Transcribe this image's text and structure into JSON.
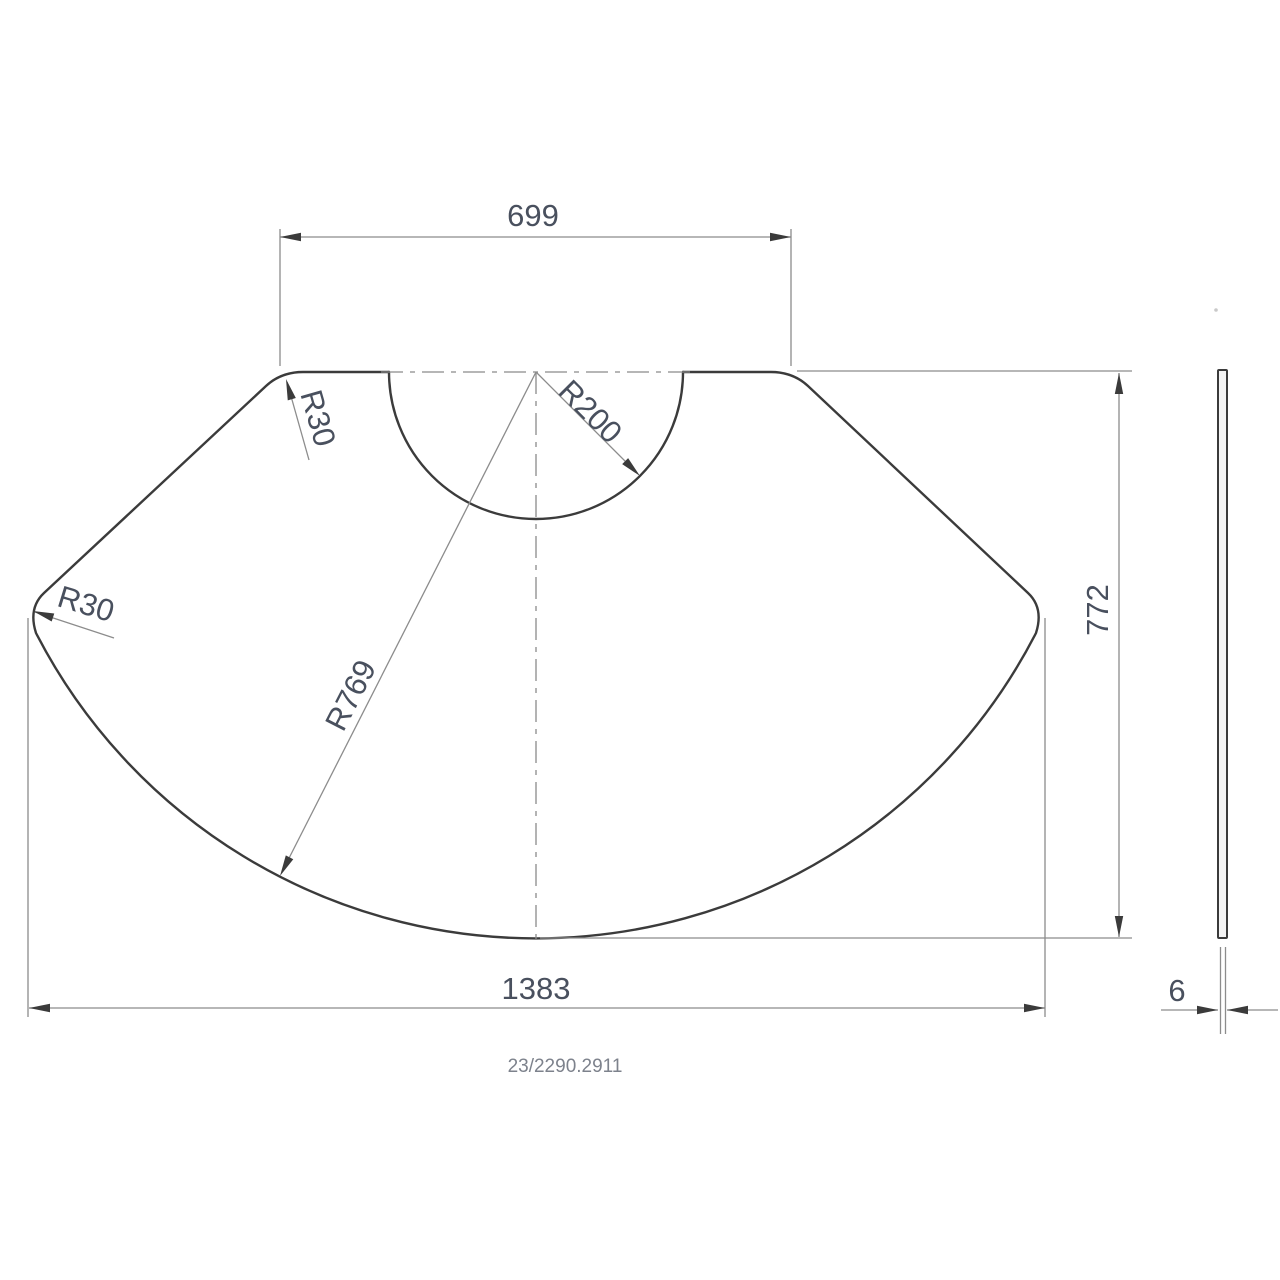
{
  "drawing": {
    "part_number": "23/2290.2911",
    "dims": {
      "top_width": "699",
      "overall_width": "1383",
      "overall_height": "772",
      "thickness": "6",
      "radius_notch": "R200",
      "radius_outer": "R769",
      "radius_corner_top_left": "R30",
      "radius_corner_left": "R30"
    },
    "colors": {
      "outline": "#3b3b3b",
      "thin_lines": "#8c8c8c",
      "dimension_text": "#49505e",
      "part_number_text": "#7d828c",
      "background": "#ffffff"
    }
  }
}
